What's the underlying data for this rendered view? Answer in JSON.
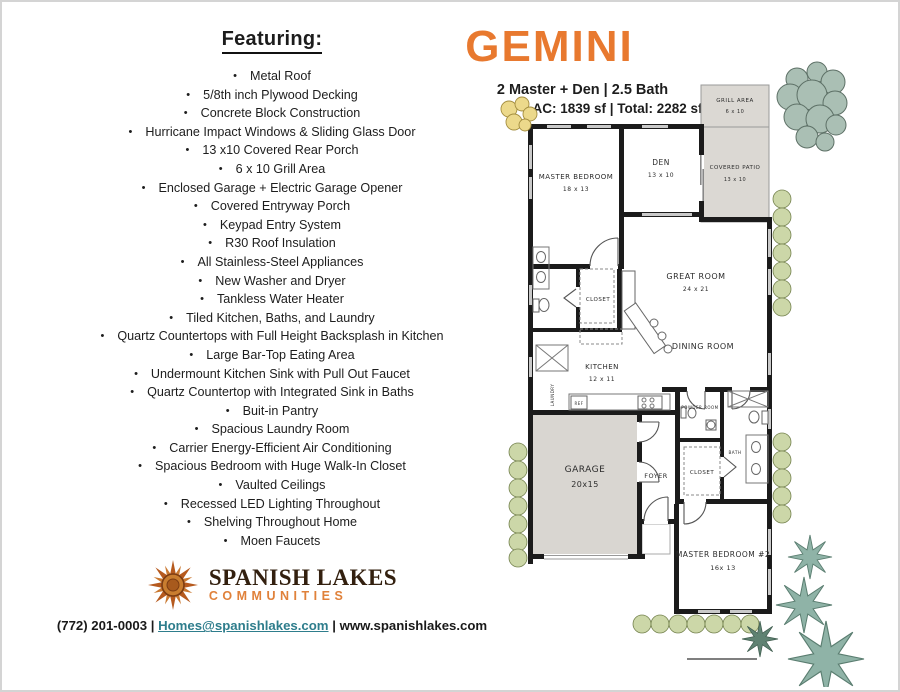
{
  "featuring": {
    "title": "Featuring:",
    "items": [
      "Metal Roof",
      "5/8th inch Plywood Decking",
      "Concrete Block Construction",
      "Hurricane Impact Windows & Sliding Glass Door",
      "13 x10 Covered Rear Porch",
      "6 x 10 Grill Area",
      "Enclosed Garage + Electric Garage Opener",
      "Covered Entryway Porch",
      "Keypad Entry System",
      "R30 Roof Insulation",
      "All Stainless-Steel Appliances",
      "New Washer and Dryer",
      "Tankless Water Heater",
      "Tiled Kitchen, Baths, and Laundry",
      "Quartz Countertops with Full Height Backsplash in Kitchen",
      "Large Bar-Top Eating Area",
      "Undermount Kitchen Sink with Pull Out Faucet",
      "Quartz Countertop with Integrated Sink in Baths",
      "Buit-in Pantry",
      "Spacious Laundry Room",
      "Carrier Energy-Efficient Air Conditioning",
      "Spacious Bedroom with Huge Walk-In Closet",
      "Vaulted Ceilings",
      "Recessed LED Lighting Throughout",
      "Shelving Throughout Home",
      "Moen Faucets"
    ]
  },
  "plan_header": {
    "title": "GEMINI",
    "subtitle": "2 Master + Den | 2.5 Bath",
    "area_line": "AC: 1839 sf | Total: 2282 sf"
  },
  "floorplan": {
    "rooms": {
      "master_bedroom": {
        "label": "MASTER BEDROOM",
        "dim": "18 x 13"
      },
      "den": {
        "label": "DEN",
        "dim": "13 x 10"
      },
      "covered_patio": {
        "label": "COVERED PATIO",
        "dim": "13 x 10"
      },
      "grill_area": {
        "label": "GRILL AREA",
        "dim": "6 x 10"
      },
      "great_room": {
        "label": "GREAT ROOM",
        "dim": "24 x 21"
      },
      "dining_room": {
        "label": "DINING ROOM"
      },
      "kitchen": {
        "label": "KITCHEN",
        "dim": "12 x 11"
      },
      "closet_master": {
        "label": "CLOSET"
      },
      "closet_mb2": {
        "label": "CLOSET"
      },
      "laundry": {
        "label": "LAUNDRY"
      },
      "ref": {
        "label": "REF"
      },
      "garage": {
        "label": "GARAGE",
        "dim": "20x15"
      },
      "foyer": {
        "label": "FOYER"
      },
      "powder_room": {
        "label": "POWDER ROOM"
      },
      "bath": {
        "label": "BATH"
      },
      "master_bedroom2": {
        "label": "MASTER BEDROOM #2",
        "dim": "16x 13"
      }
    }
  },
  "logo": {
    "name": "SPANISH LAKES",
    "subname": "COMMUNITIES"
  },
  "footer": {
    "phone": "(772) 201-0003",
    "sep": "|",
    "email": "Homes@spanishlakes.com",
    "website": "www.spanishlakes.com"
  },
  "colors": {
    "accent_orange": "#E8792F",
    "logo_brown": "#33200F",
    "logo_orange": "#E0813A",
    "link_teal": "#2E7D8C",
    "wall_black": "#1B1B1B",
    "gray_fill": "#DBD8D3",
    "bush_green": "#CCD7A8",
    "tree_green": "#AABFB4",
    "agave_green": "#8FB3A7",
    "yellow_bush": "#ECD98B"
  }
}
